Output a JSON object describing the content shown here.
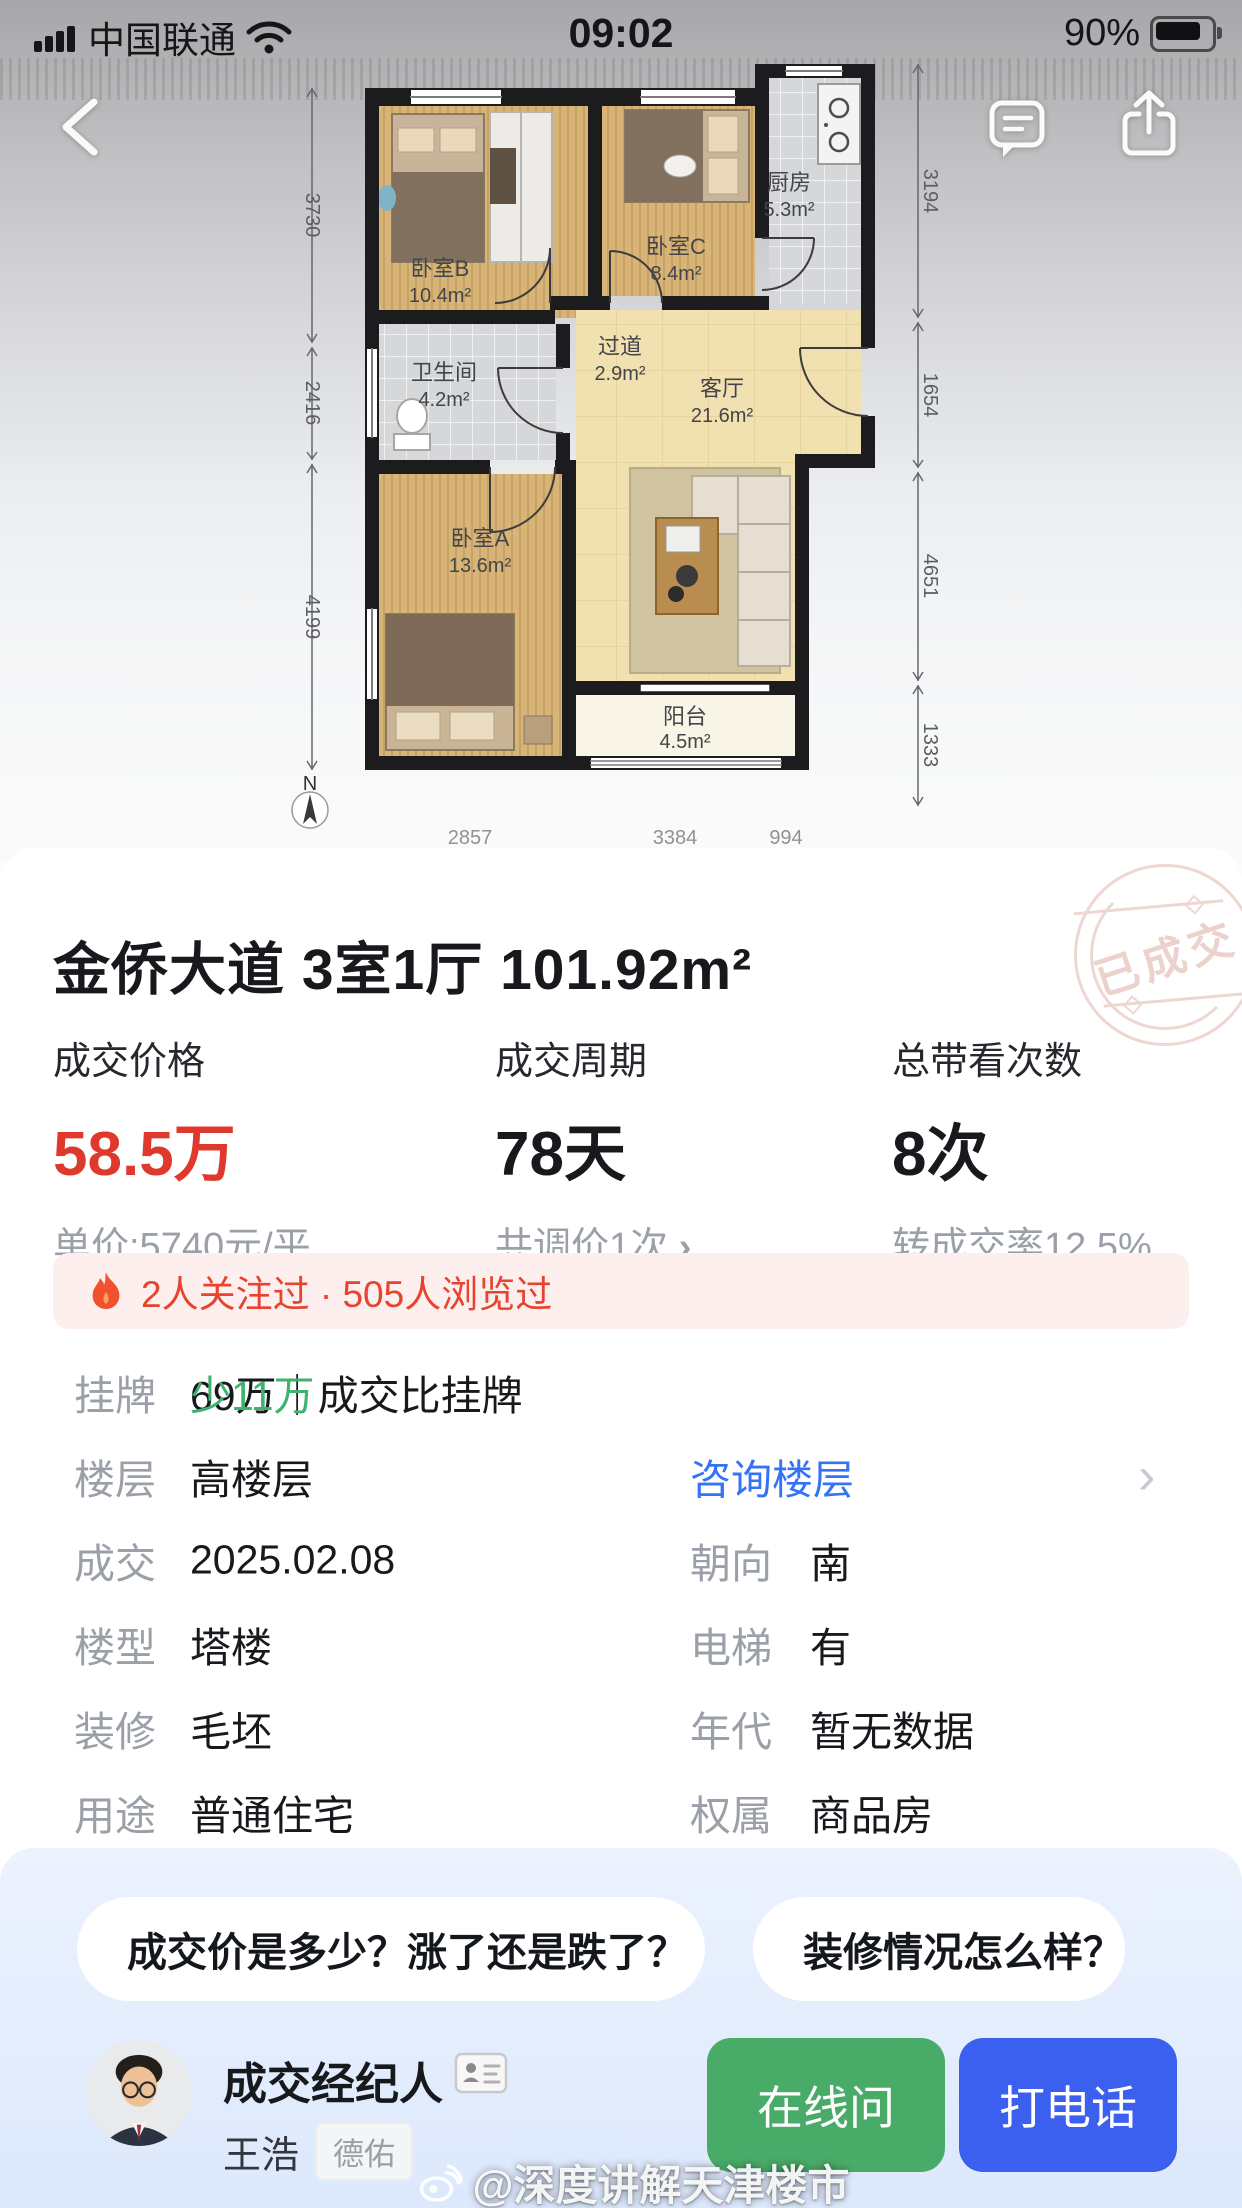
{
  "status_bar": {
    "carrier": "中国联通",
    "time": "09:02",
    "battery_percent": "90%"
  },
  "floor_plan": {
    "compass": "N",
    "rooms": [
      {
        "name": "卧室B",
        "area": "10.4m²"
      },
      {
        "name": "卧室C",
        "area": "8.4m²"
      },
      {
        "name": "厨房",
        "area": "5.3m²"
      },
      {
        "name": "卫生间",
        "area": "4.2m²"
      },
      {
        "name": "过道",
        "area": "2.9m²"
      },
      {
        "name": "客厅",
        "area": "21.6m²"
      },
      {
        "name": "卧室A",
        "area": "13.6m²"
      },
      {
        "name": "阳台",
        "area": "4.5m²"
      }
    ],
    "dims_left": [
      "3730",
      "2416",
      "4199"
    ],
    "dims_right": [
      "3194",
      "1654",
      "4651",
      "1333"
    ],
    "dims_bottom": [
      "2857",
      "3384",
      "994"
    ]
  },
  "listing": {
    "title": "金侨大道 3室1厅 101.92m²",
    "stamp": "已成交",
    "stats": [
      {
        "label": "成交价格",
        "value": "58.5万",
        "sub": "单价:5740元/平"
      },
      {
        "label": "成交周期",
        "value": "78天",
        "sub": "共调价1次",
        "sub_arrow": "›"
      },
      {
        "label": "总带看次数",
        "value": "8次",
        "sub": "转成交率12.5%"
      }
    ],
    "hot_banner": "2人关注过 · 505人浏览过",
    "listed_row": {
      "label": "挂牌",
      "value": "69万｜成交比挂牌",
      "highlight": "少11万"
    },
    "floor_row": {
      "label": "楼层",
      "value": "高楼层",
      "link": "咨询楼层",
      "arrow": "›"
    },
    "rows": [
      {
        "label": "成交",
        "value": "2025.02.08",
        "label2": "朝向",
        "value2": "南"
      },
      {
        "label": "楼型",
        "value": "塔楼",
        "label2": "电梯",
        "value2": "有"
      },
      {
        "label": "装修",
        "value": "毛坯",
        "label2": "年代",
        "value2": "暂无数据"
      },
      {
        "label": "用途",
        "value": "普通住宅",
        "label2": "权属",
        "value2": "商品房"
      }
    ]
  },
  "qa": {
    "chips": [
      "成交价是多少？涨了还是跌了？",
      "装修情况怎么样？"
    ]
  },
  "agent": {
    "role": "成交经纪人",
    "name": "王浩",
    "company": "德佑",
    "online_label": "在线问",
    "call_label": "打电话"
  },
  "watermark": "@深度讲解天津楼市",
  "colors": {
    "price_red": "#df382c",
    "link_blue": "#3473f5",
    "deal_green": "#3eb36f",
    "banner_bg": "#fdefee",
    "banner_text": "#e7432e",
    "btn_green": "#49ab68",
    "btn_blue": "#3b5fee"
  }
}
